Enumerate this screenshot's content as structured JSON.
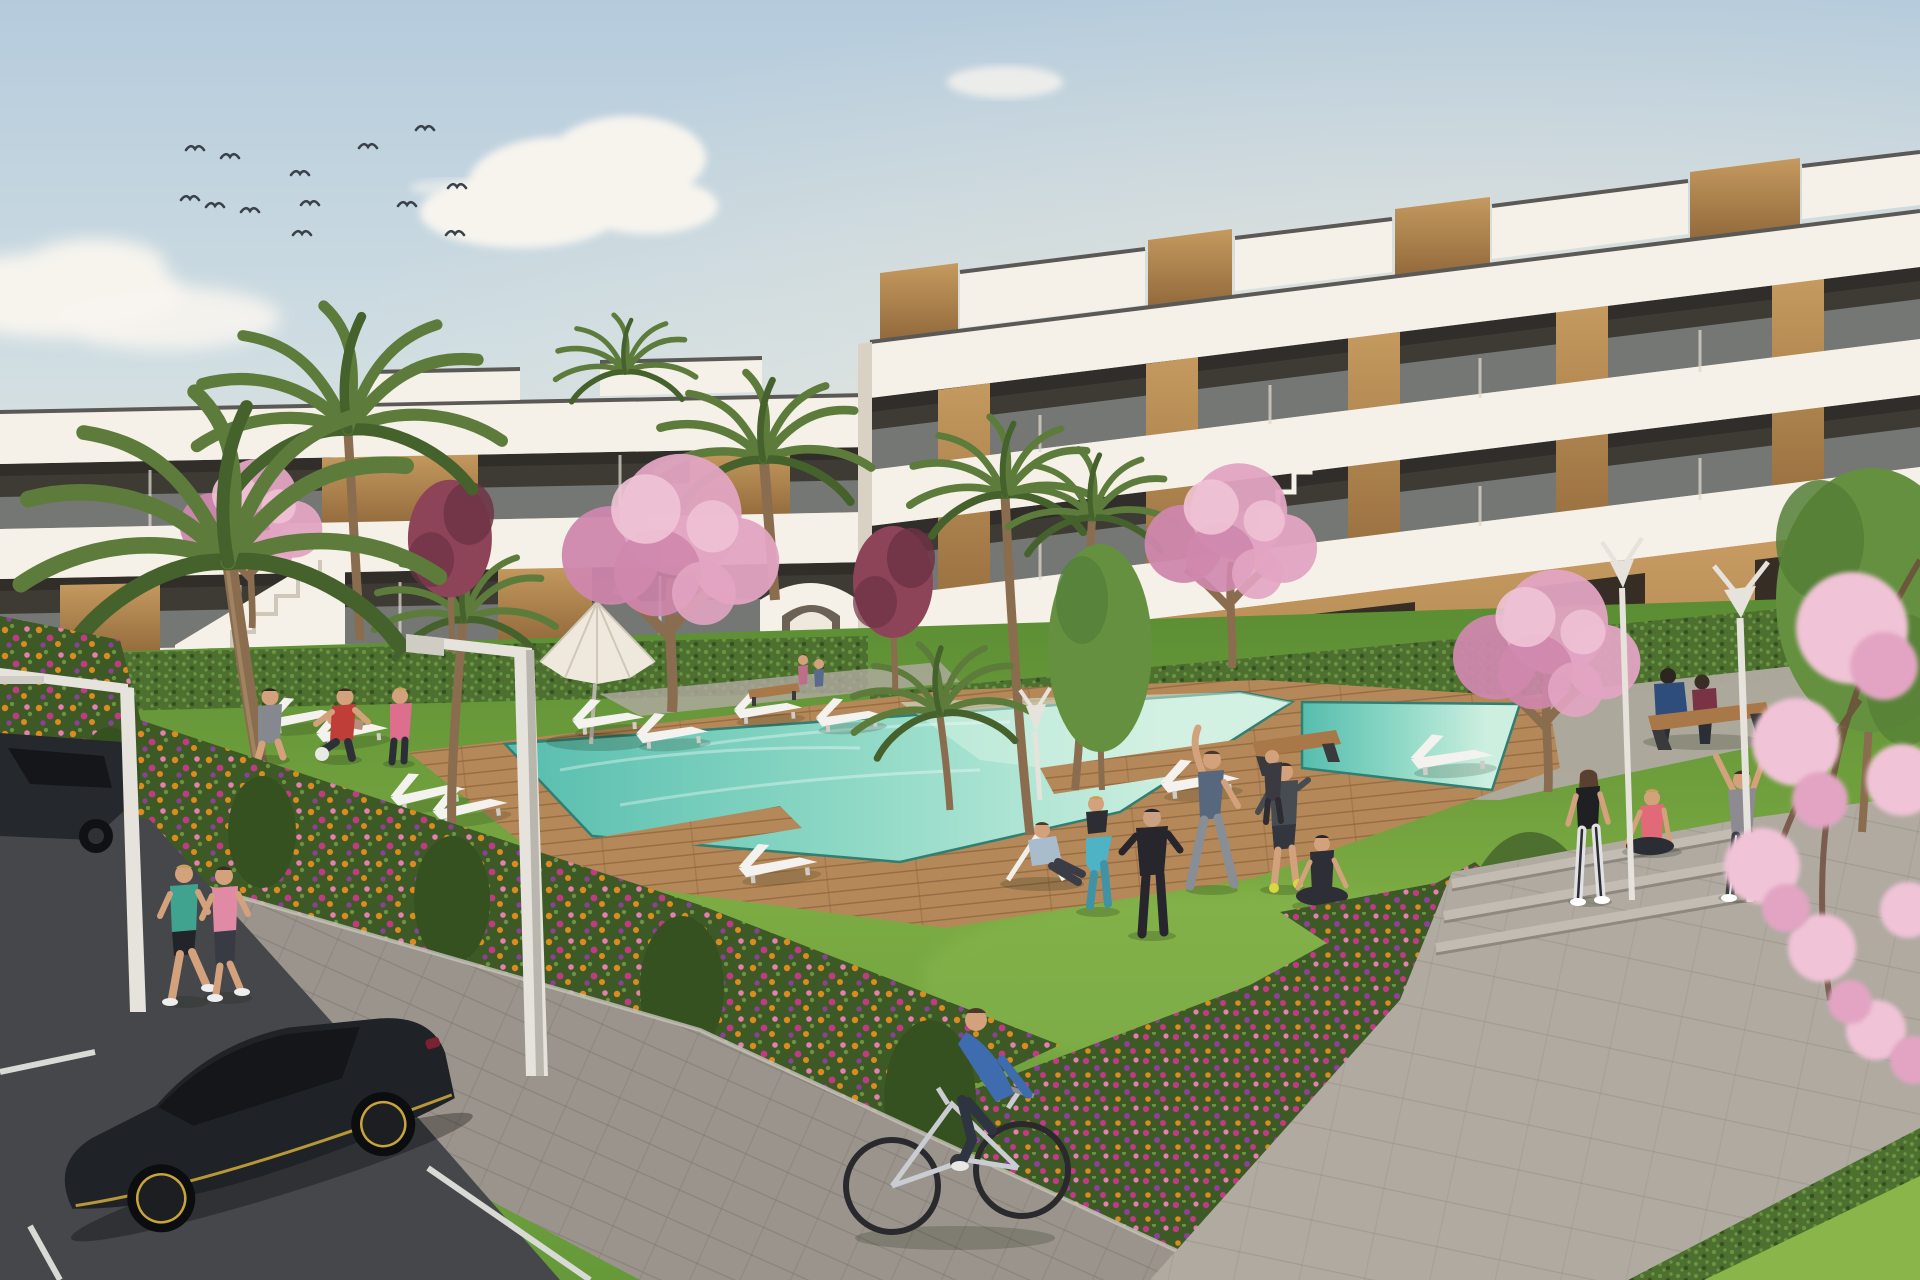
{
  "scene": {
    "title": "Modern residential complex with communal garden and pool - architectural rendering",
    "width": 1920,
    "height": 1280,
    "setting": "Two white apartment blocks with wood-clad accents and glass balconies around a landscaped courtyard with turquoise swimming pool, wooden deck, lawns, cherry-blossom trees, palms, flower beds, a paved walk, and a parking road with black cars in the foreground"
  },
  "palette": {
    "sky_top": "#b5cbdc",
    "sky_mid": "#cfdde2",
    "sky_horizon": "#e9e6da",
    "cloud": "#f7f4ee",
    "cloud_warm": "#f0e7da",
    "building_white": "#efe9df",
    "building_shadow": "#d9d2c4",
    "fascia_white": "#f6f1e8",
    "glass_dark": "#3e3b35",
    "glass_top": "#2e2c28",
    "balustrade": "#b9c1c2",
    "mullion": "#ddd8cc",
    "coping": "#5a5955",
    "wood_panel": "#c59a5f",
    "wood_dark": "#91683a",
    "ground_tan": "#c99d63",
    "ground_tan_dark": "#a87f4b",
    "door_dark": "#362e24",
    "hedge": "#4d7030",
    "hedge_light": "#699441",
    "hedge_dark": "#35511f",
    "lawn_far": "#5a8c33",
    "lawn_mid": "#7cab43",
    "lawn_near": "#669939",
    "lawn_corner": "#8ab54a",
    "deck_wood": "#b5885a",
    "deck_line": "#8a6238",
    "pool_deep": "#56bdae",
    "pool_mid": "#8fd9c6",
    "pool_shallow": "#cdefe0",
    "pool_edge": "#2f7f72",
    "flower_base": "#3d5a26",
    "flower_orange": "#dd8a1f",
    "flower_magenta": "#c23a84",
    "flower_pink": "#e77fae",
    "flower_purple": "#8e3f9b",
    "leaf_light": "#6c9440",
    "blossom_pink": "#e2a4c2",
    "blossom_light": "#f0c3d6",
    "blossom_deep": "#cf87ad",
    "purple_tree": "#8e4458",
    "purple_tree_dark": "#6e3245",
    "palm_green": "#5d7c3c",
    "palm_dark": "#46622c",
    "trunk_brown": "#8a6d4e",
    "green_tree": "#64903f",
    "road_asphalt": "#45474b",
    "road_line": "#d9d9d6",
    "sidewalk": "#9b948c",
    "plaza": "#b0aaa1",
    "step_light": "#c2bcb2",
    "lamp_white": "#e6e3dc",
    "lounger_white": "#f3f2ee",
    "bench_wood": "#a87848",
    "metal_dark": "#3a3a3c",
    "skin": "#d3a27c",
    "car_black": "#1f2226",
    "car_glass": "#14161a",
    "car_accent": "#c8a43a",
    "bird_dark": "#3a4148"
  },
  "inventory": {
    "buildings": 2,
    "building_floors_right": 3,
    "building_floors_left": 2,
    "swimming_pools": 1,
    "wooden_piers": 2,
    "parasols": 1,
    "sun_loungers": 11,
    "deck_chairs": 1,
    "benches": 3,
    "street_lamps": 5,
    "palm_trees": 8,
    "blossom_trees": 5,
    "purple_leaf_trees": 2,
    "green_trees": 2,
    "flower_beds": 4,
    "people": 18,
    "joggers": 2,
    "cyclists": 1,
    "cars": 2,
    "birds": 13,
    "clouds": 6,
    "steps": 3
  }
}
